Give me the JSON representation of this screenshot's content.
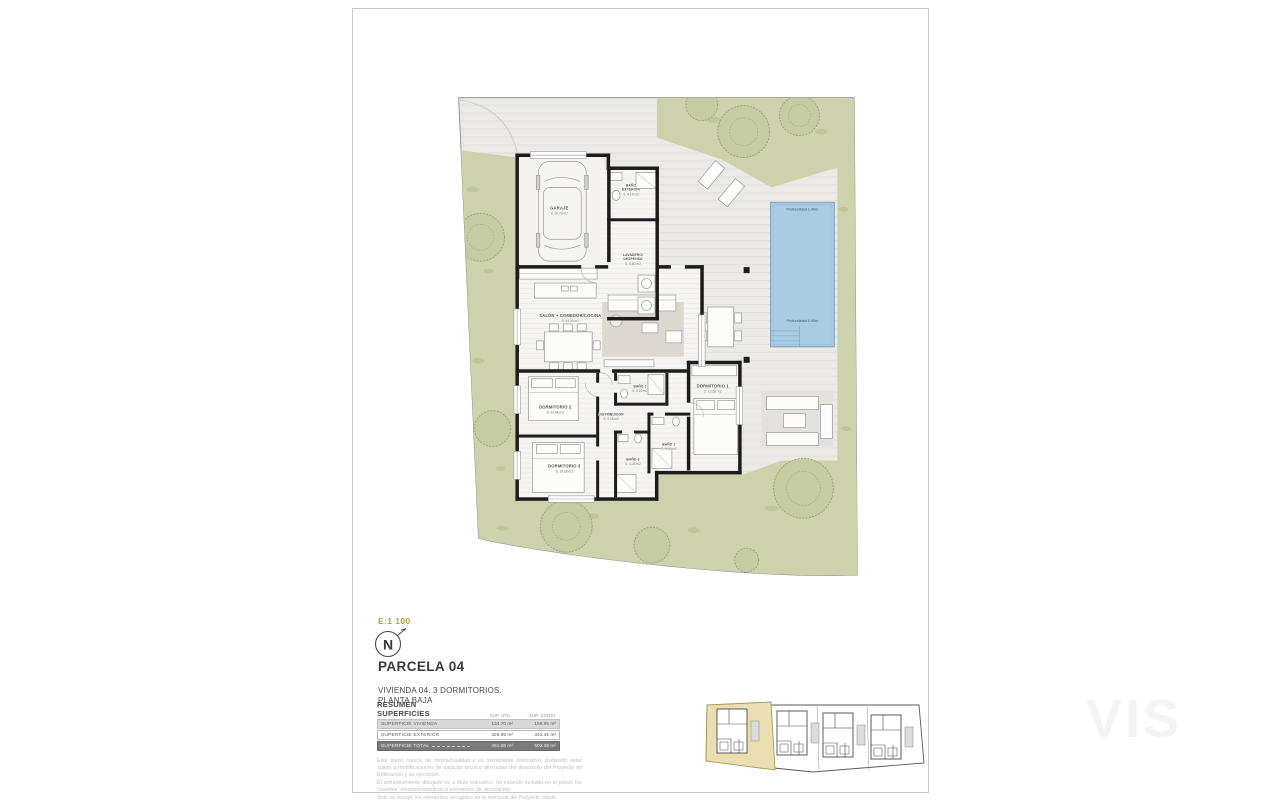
{
  "sheet": {
    "scale_label": "E:1 100",
    "north_label": "N",
    "title": "PARCELA 04",
    "subtitle_line1": "VIVIENDA 04. 3 DORMITORIOS.",
    "subtitle_line2": "PLANTA BAJA",
    "watermark": "VIS"
  },
  "summary_table": {
    "title": "RESUMEN SUPERFICIES",
    "col_util": "SUP. ÚTIL",
    "col_const": "SUP. CONST.",
    "rows": [
      {
        "label": "SUPERFICIE VIVIENDA",
        "util": "134.70 m²",
        "const": "159.95 m²"
      },
      {
        "label": "SUPERFICIE EXTERIOR",
        "util": "326.95 m²",
        "const": "342.41 m²"
      },
      {
        "label": "SUPERFICIE TOTAL",
        "util": "461.65 m²",
        "const": "502.36 m²"
      }
    ]
  },
  "disclaimer": {
    "p1": "Este plano carece de contractualidad y es meramente orientativo, pudiendo estar sujeto a modificaciones de carácter técnico derivadas del desarrollo del Proyecto de Edificación y su ejecución.",
    "p2": "El amueblamiento dibujado es a título indicativo, no estando incluido en el precio los muebles, electrodomésticos o elementos de decoración.",
    "p3": "Solo se incluye los elementos recogidos en la memoria del Proyecto citado."
  },
  "plan": {
    "rooms": [
      {
        "line1": "GARAJE",
        "line2": "",
        "area": "S: 20.79 m2"
      },
      {
        "line1": "BAÑO",
        "line2": "EXTERIOR",
        "area": "S: 4.14 m2"
      },
      {
        "line1": "LAVADERO/",
        "line2": "DESPENSA",
        "area": "S: 5.50 m2"
      },
      {
        "line1": "SALÓN + COMEDOR/COCINA",
        "line2": "",
        "area": "S: 44.90 m2"
      },
      {
        "line1": "DORMITORIO 2",
        "line2": "",
        "area": "S: 11.48 m2"
      },
      {
        "line1": "BAÑO 2",
        "line2": "",
        "area": "S: 5.03 m2"
      },
      {
        "line1": "DISTRIBUIDOR",
        "line2": "",
        "area": "S: 9.08 m2"
      },
      {
        "line1": "DORMITORIO 3",
        "line2": "",
        "area": "S: 10.28 m2"
      },
      {
        "line1": "BAÑO 3",
        "line2": "",
        "area": "S: 4.43 m2"
      },
      {
        "line1": "DORMITORIO 1",
        "line2": "",
        "area": "S: 13.58 m2"
      },
      {
        "line1": "BAÑO 1",
        "line2": "",
        "area": "S: 5.49 m2"
      }
    ],
    "pool": {
      "depth_deep": "Profundidad 1.40m",
      "depth_shallow": "Profundidad 0.90m"
    }
  },
  "colors": {
    "pool": "#a9cbe3",
    "garden": "#cdd2ac",
    "wall": "#1c1c1c",
    "parcel_highlight": "#eadfb2",
    "scale_accent": "#b5a245"
  }
}
